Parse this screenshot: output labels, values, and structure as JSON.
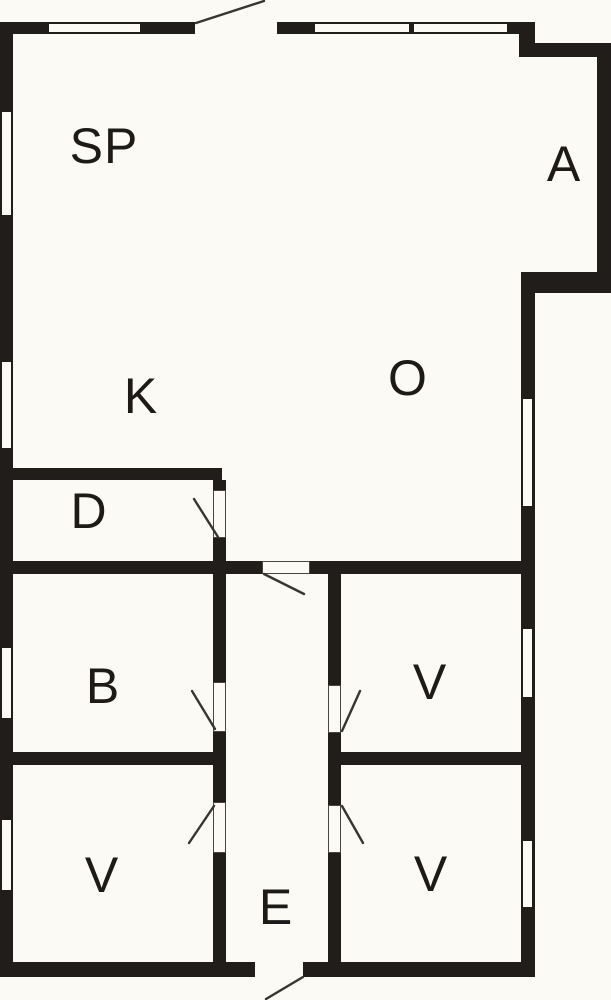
{
  "plan": {
    "rooms": [
      {
        "id": "sp",
        "label": "SP"
      },
      {
        "id": "a",
        "label": "A"
      },
      {
        "id": "k",
        "label": "K"
      },
      {
        "id": "o",
        "label": "O"
      },
      {
        "id": "d",
        "label": "D"
      },
      {
        "id": "b",
        "label": "B"
      },
      {
        "id": "v_bottom_left",
        "label": "V"
      },
      {
        "id": "v_top_right",
        "label": "V"
      },
      {
        "id": "v_bottom_right",
        "label": "V"
      },
      {
        "id": "e",
        "label": "E"
      }
    ],
    "colors": {
      "wall": "#201d1b",
      "background": "#fbfaf5",
      "door_line": "#38342f"
    }
  }
}
